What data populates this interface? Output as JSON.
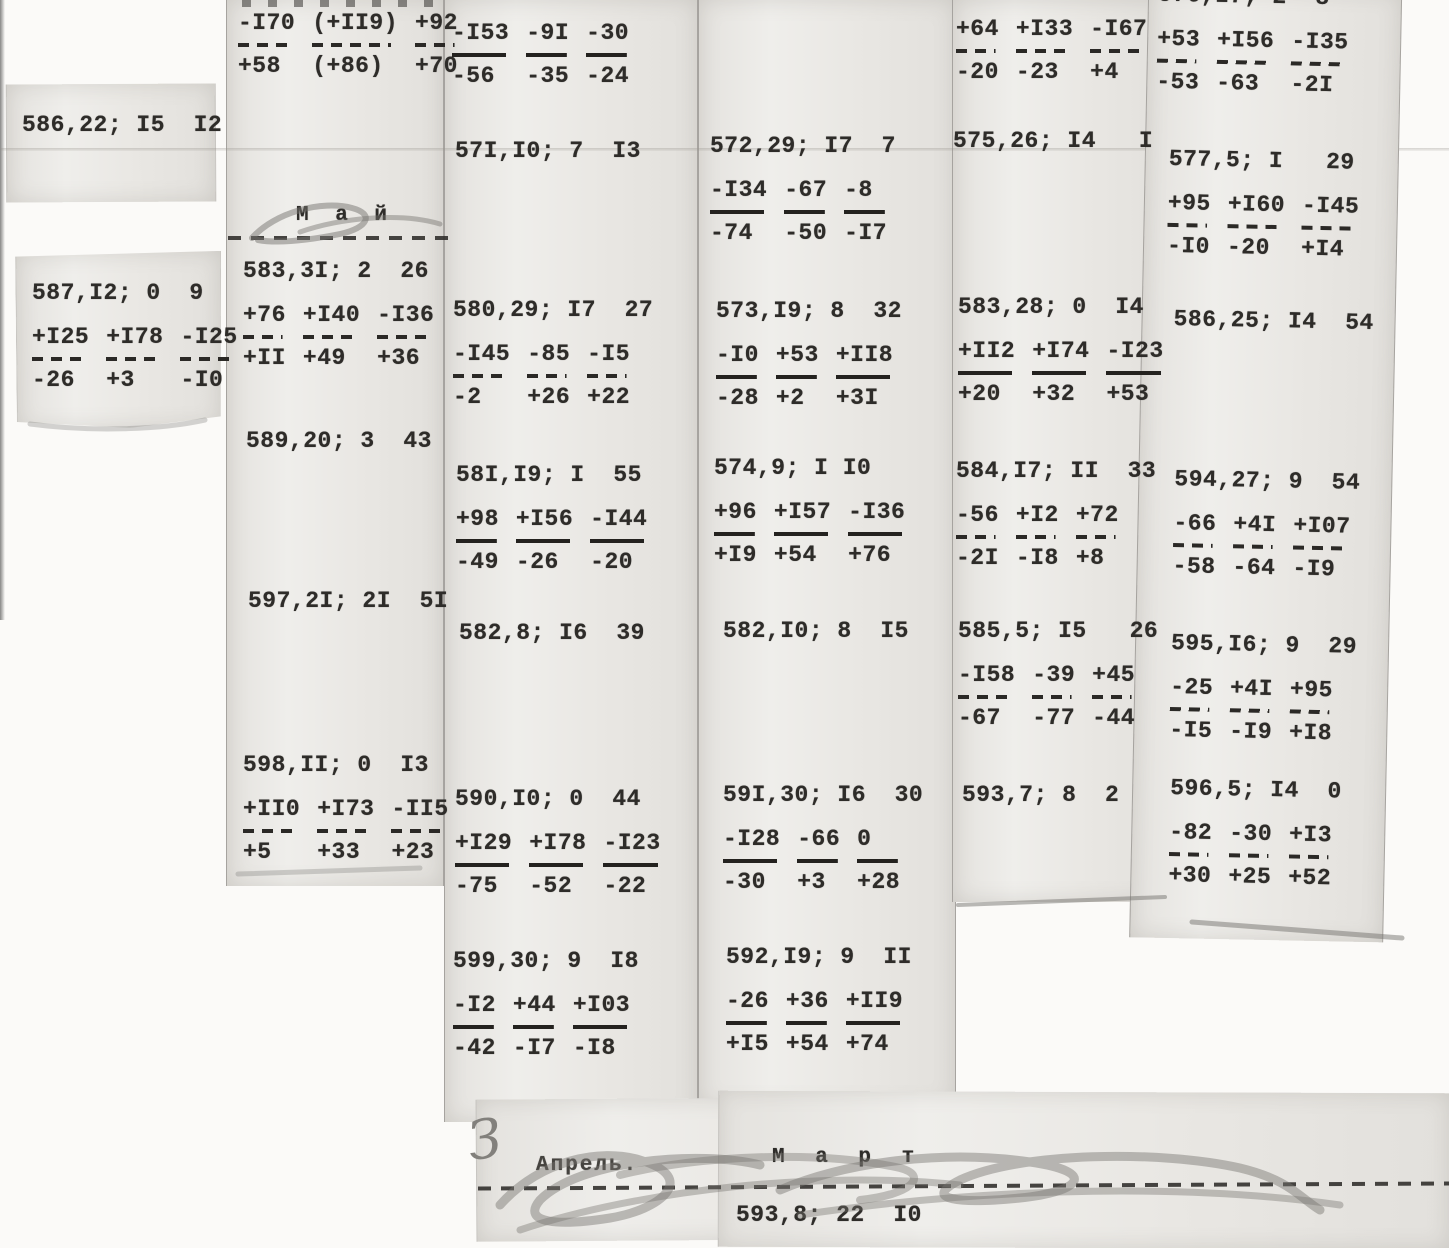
{
  "months": {
    "may": "М а й",
    "april": "Апрель.",
    "march": "М а р т"
  },
  "handwritten_mark": "З",
  "footer_entry": "593,8; 22  I0",
  "columns": [
    {
      "name": "column-1",
      "entries": [
        {
          "left": 22,
          "top": 112,
          "header": "586,22; I5  I2"
        },
        {
          "left": 32,
          "top": 280,
          "header": "587,I2; 0  9",
          "row1": [
            "+I25",
            "+I78",
            "-I25"
          ],
          "rule": "dashed",
          "row2": [
            "-26",
            "+3",
            "-I0"
          ]
        }
      ]
    },
    {
      "name": "column-2",
      "entries": [
        {
          "left": 238,
          "top": 8,
          "row1": [
            "-I70",
            "(+II9)",
            "+92"
          ],
          "rule": "dashed",
          "row2": [
            "+58",
            "(+86)",
            "+70"
          ]
        },
        {
          "left": 243,
          "top": 258,
          "header": "583,3I; 2  26",
          "row1": [
            "+76",
            "+I40",
            "-I36"
          ],
          "rule": "dashed",
          "row2": [
            "+II",
            "+49",
            "+36"
          ]
        },
        {
          "left": 246,
          "top": 428,
          "header": "589,20; 3  43"
        },
        {
          "left": 248,
          "top": 588,
          "header": "597,2I; 2I  5I"
        },
        {
          "left": 243,
          "top": 752,
          "header": "598,II; 0  I3",
          "row1": [
            "+II0",
            "+I73",
            "-II5"
          ],
          "rule": "dashed",
          "row2": [
            "+5",
            "+33",
            "+23"
          ]
        }
      ]
    },
    {
      "name": "column-3",
      "entries": [
        {
          "left": 452,
          "top": 18,
          "row1": [
            "-I53",
            "-9I",
            "-30"
          ],
          "rule": "solid",
          "row2": [
            "-56",
            "-35",
            "-24"
          ]
        },
        {
          "left": 455,
          "top": 138,
          "header": "57I,I0; 7  I3"
        },
        {
          "left": 453,
          "top": 297,
          "header": "580,29; I7  27",
          "row1": [
            "-I45",
            "-85",
            "-I5"
          ],
          "rule": "dashed",
          "row2": [
            "-2",
            "+26",
            "+22"
          ]
        },
        {
          "left": 456,
          "top": 462,
          "header": "58I,I9; I  55",
          "row1": [
            "+98",
            "+I56",
            "-I44"
          ],
          "rule": "solid",
          "row2": [
            "-49",
            "-26",
            "-20"
          ]
        },
        {
          "left": 459,
          "top": 620,
          "header": "582,8; I6  39"
        },
        {
          "left": 455,
          "top": 786,
          "header": "590,I0; 0  44",
          "row1": [
            "+I29",
            "+I78",
            "-I23"
          ],
          "rule": "solid",
          "row2": [
            "-75",
            "-52",
            "-22"
          ]
        },
        {
          "left": 453,
          "top": 948,
          "header": "599,30; 9  I8",
          "row1": [
            "-I2",
            "+44",
            "+I03"
          ],
          "rule": "solid",
          "row2": [
            "-42",
            "-I7",
            "-I8"
          ]
        }
      ]
    },
    {
      "name": "column-4",
      "entries": [
        {
          "left": 710,
          "top": 133,
          "header": "572,29; I7  7",
          "row1": [
            "-I34",
            "-67",
            "-8"
          ],
          "rule": "solid",
          "row2": [
            "-74",
            "-50",
            "-I7"
          ]
        },
        {
          "left": 716,
          "top": 298,
          "header": "573,I9; 8  32",
          "row1": [
            "-I0",
            "+53",
            "+II8"
          ],
          "rule": "solid",
          "row2": [
            "-28",
            "+2",
            "+3I"
          ]
        },
        {
          "left": 714,
          "top": 455,
          "header": "574,9; I I0",
          "row1": [
            "+96",
            "+I57",
            "-I36"
          ],
          "rule": "solid",
          "row2": [
            "+I9",
            "+54",
            "+76"
          ]
        },
        {
          "left": 723,
          "top": 618,
          "header": "582,I0; 8  I5"
        },
        {
          "left": 723,
          "top": 782,
          "header": "59I,30; I6  30",
          "row1": [
            "-I28",
            "-66",
            "0"
          ],
          "rule": "solid",
          "row2": [
            "-30",
            "+3",
            "+28"
          ]
        },
        {
          "left": 726,
          "top": 944,
          "header": "592,I9; 9  II",
          "row1": [
            "-26",
            "+36",
            "+II9"
          ],
          "rule": "solid",
          "row2": [
            "+I5",
            "+54",
            "+74"
          ]
        }
      ]
    },
    {
      "name": "column-5",
      "entries": [
        {
          "left": 956,
          "top": 14,
          "row1": [
            "+64",
            "+I33",
            "-I67"
          ],
          "rule": "dashed",
          "row2": [
            "-20",
            "-23",
            "+4"
          ]
        },
        {
          "left": 953,
          "top": 128,
          "header": "575,26; I4   I"
        },
        {
          "left": 958,
          "top": 294,
          "header": "583,28; 0  I4",
          "row1": [
            "+II2",
            "+I74",
            "-I23"
          ],
          "rule": "solid",
          "row2": [
            "+20",
            "+32",
            "+53"
          ]
        },
        {
          "left": 956,
          "top": 458,
          "header": "584,I7; II  33",
          "row1": [
            "-56",
            "+I2",
            "+72"
          ],
          "rule": "dashed",
          "row2": [
            "-2I",
            "-I8",
            "+8"
          ]
        },
        {
          "left": 958,
          "top": 618,
          "header": "585,5; I5   26",
          "row1": [
            "-I58",
            "-39",
            "+45"
          ],
          "rule": "dashed",
          "row2": [
            "-67",
            "-77",
            "-44"
          ]
        },
        {
          "left": 962,
          "top": 782,
          "header": "593,7; 8  2"
        }
      ]
    },
    {
      "name": "column-6",
      "entries": [
        {
          "left": 12,
          "top": -18,
          "layer": "col6",
          "header": "576,I7; 2  8",
          "row1": [
            "+53",
            "+I56",
            "-I35"
          ],
          "rule": "dashed",
          "row2": [
            "-53",
            "-63",
            "-2I"
          ]
        },
        {
          "left": 26,
          "top": 146,
          "layer": "col6",
          "header": "577,5; I   29",
          "row1": [
            "+95",
            "+I60",
            "-I45"
          ],
          "rule": "dashed",
          "row2": [
            "-I0",
            "-20",
            "+I4"
          ]
        },
        {
          "left": 34,
          "top": 306,
          "layer": "col6",
          "header": "586,25; I4  54"
        },
        {
          "left": 38,
          "top": 466,
          "layer": "col6",
          "header": "594,27; 9  54",
          "row1": [
            "-66",
            "+4I",
            "+I07"
          ],
          "rule": "dashed",
          "row2": [
            "-58",
            "-64",
            "-I9"
          ]
        },
        {
          "left": 38,
          "top": 630,
          "layer": "col6",
          "header": "595,I6; 9  29",
          "row1": [
            "-25",
            "+4I",
            "+95"
          ],
          "rule": "dashed",
          "row2": [
            "-I5",
            "-I9",
            "+I8"
          ]
        },
        {
          "left": 40,
          "top": 775,
          "layer": "col6",
          "header": "596,5; I4  0",
          "row1": [
            "-82",
            "-30",
            "+I3"
          ],
          "rule": "dashed",
          "row2": [
            "+30",
            "+25",
            "+52"
          ]
        }
      ]
    }
  ]
}
